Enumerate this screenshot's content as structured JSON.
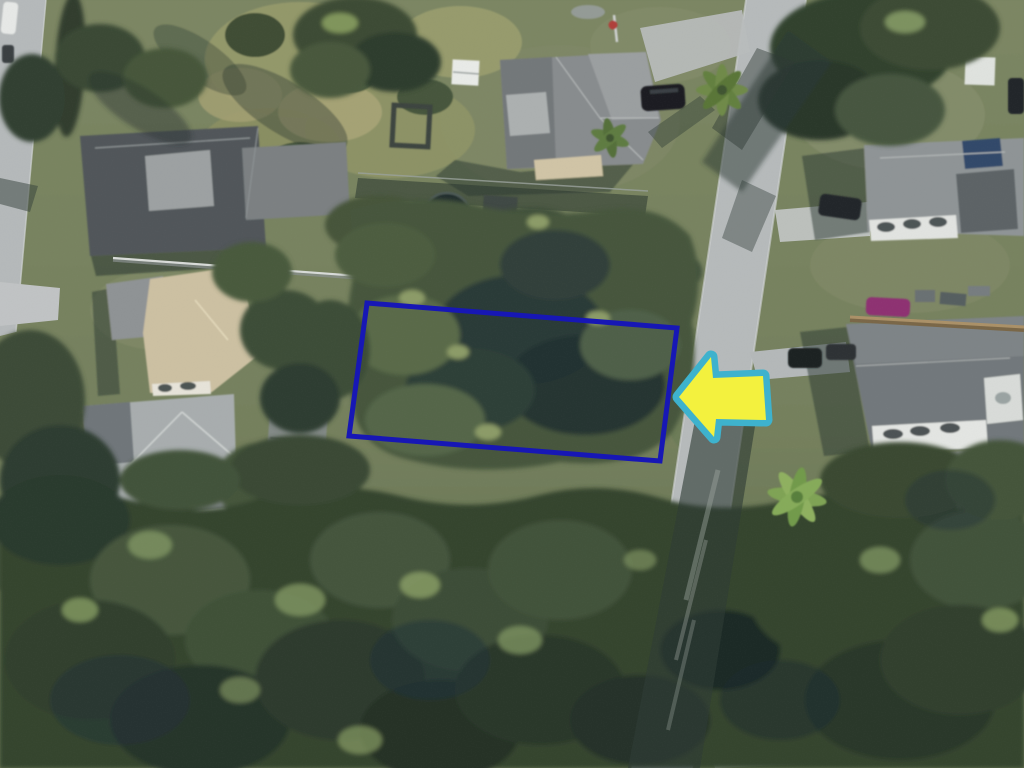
{
  "scene": {
    "name": "aerial-lot-photo",
    "view": "satellite-aerial-view",
    "features": {
      "highlighted_lot": "wooded-vacant-lot",
      "street": "residential-street",
      "surroundings": "single-family-homes-and-tree-canopy"
    }
  },
  "annotations": {
    "property_outline": {
      "icon": "rectangle-outline",
      "color": "#1717b5",
      "stroke_width": "5"
    },
    "pointer_arrow": {
      "icon": "left-arrow",
      "direction": "left",
      "fill_color": "#f3f13e",
      "border_color": "#3eb2cd",
      "border_width": "7"
    }
  },
  "palette": {
    "road": "#b6babb",
    "grass": "#77825f",
    "tree_dark": "#2c3a2d",
    "tree_mid": "#3e4e37",
    "roof_dark": "#51575a",
    "roof_light": "#a7abac",
    "roof_tan": "#ccc0a2"
  }
}
